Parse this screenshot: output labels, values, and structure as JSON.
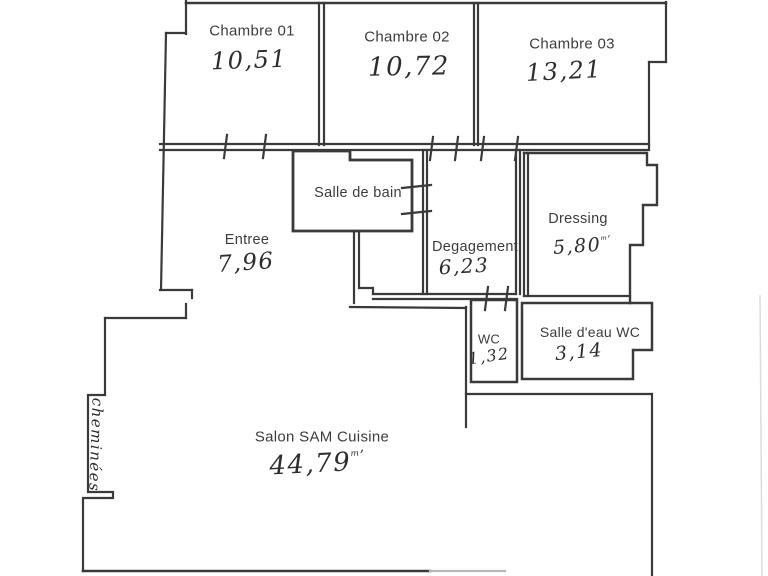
{
  "rooms": [
    {
      "id": "chambre-01",
      "label": "Chambre 01",
      "area": "10,51"
    },
    {
      "id": "chambre-02",
      "label": "Chambre 02",
      "area": "10,72"
    },
    {
      "id": "chambre-03",
      "label": "Chambre 03",
      "area": "13,21"
    },
    {
      "id": "salle-de-bain",
      "label": "Salle de bain",
      "area": ""
    },
    {
      "id": "entree",
      "label": "Entree",
      "area": "7,96"
    },
    {
      "id": "degagement",
      "label": "Degagement",
      "area": "6,23"
    },
    {
      "id": "dressing",
      "label": "Dressing",
      "area": "5,80",
      "area_suffix": "ᵐ’"
    },
    {
      "id": "wc",
      "label": "WC",
      "area": "1,32"
    },
    {
      "id": "salle-deau-wc",
      "label": "Salle d'eau WC",
      "area": "3,14"
    },
    {
      "id": "salon",
      "label": "Salon SAM Cuisine",
      "area": "44,79",
      "area_suffix": "ᵐ’"
    }
  ],
  "annotations": {
    "cheminee": "cheminées"
  },
  "colors": {
    "wall": "#3a3a3a",
    "printed_text": "#3c3c3c",
    "handwriting": "#2d2d2d",
    "background": "#ffffff"
  }
}
